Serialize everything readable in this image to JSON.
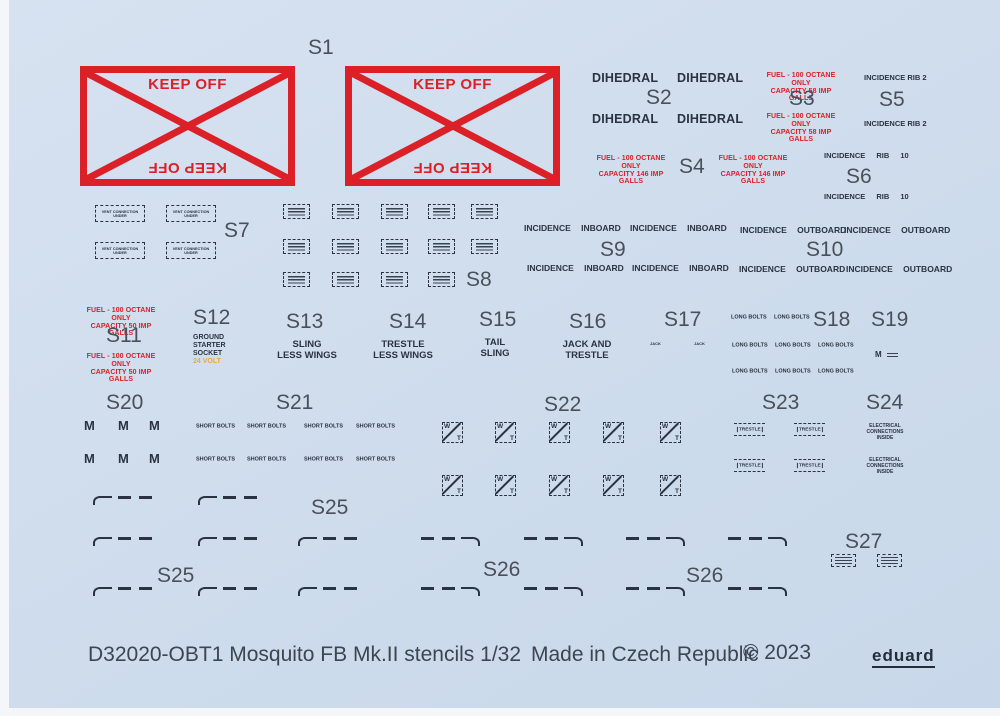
{
  "colors": {
    "background": "#cfdded",
    "red": "#dc2027",
    "dark": "#2b3340",
    "orange": "#e9a93c"
  },
  "s1": {
    "label": "S1",
    "text": "KEEP OFF"
  },
  "s2": {
    "label": "S2",
    "text": "DIHEDRAL"
  },
  "s3": {
    "label": "S3",
    "line1": "FUEL - 100 OCTANE ONLY",
    "line2": "CAPACITY 58 IMP GALLS"
  },
  "s4": {
    "label": "S4",
    "line1": "FUEL - 100 OCTANE ONLY",
    "line2": "CAPACITY 146 IMP GALLS"
  },
  "s5": {
    "label": "S5",
    "text": "INCIDENCE RIB 2"
  },
  "s6": {
    "label": "S6",
    "text": "INCIDENCE RIB 10"
  },
  "s7": {
    "label": "S7",
    "box_text": "VENT CONNECTION UNDER"
  },
  "s8": {
    "label": "S8"
  },
  "s9": {
    "label": "S9",
    "text": "INCIDENCE INBOARD"
  },
  "s10": {
    "label": "S10",
    "text": "INCIDENCE OUTBOARD"
  },
  "s11": {
    "label": "S11",
    "line1": "FUEL - 100 OCTANE ONLY",
    "line2": "CAPACITY 50 IMP GALLS"
  },
  "s12": {
    "label": "S12",
    "line1": "GROUND",
    "line2": "STARTER",
    "line3": "SOCKET",
    "line4": "24 VOLT"
  },
  "s13": {
    "label": "S13",
    "line1": "SLING",
    "line2": "LESS WINGS"
  },
  "s14": {
    "label": "S14",
    "line1": "TRESTLE",
    "line2": "LESS WINGS"
  },
  "s15": {
    "label": "S15",
    "line1": "TAIL",
    "line2": "SLING"
  },
  "s16": {
    "label": "S16",
    "line1": "JACK AND",
    "line2": "TRESTLE"
  },
  "s17": {
    "label": "S17",
    "text": "JACK"
  },
  "s18": {
    "label": "S18",
    "text": "LONG BOLTS"
  },
  "s19": {
    "label": "S19",
    "text": "M"
  },
  "s20": {
    "label": "S20",
    "text": "M"
  },
  "s21": {
    "label": "S21",
    "text": "SHORT BOLTS"
  },
  "s22": {
    "label": "S22",
    "w": "W",
    "t": "T"
  },
  "s23": {
    "label": "S23",
    "text": "TRESTLE"
  },
  "s24": {
    "label": "S24",
    "line1": "ELECTRICAL",
    "line2": "CONNECTIONS",
    "line3": "INSIDE"
  },
  "s25": {
    "label": "S25"
  },
  "s26": {
    "label": "S26"
  },
  "s27": {
    "label": "S27"
  },
  "footer": {
    "product": "D32020-OBT1 Mosquito FB Mk.II stencils 1/32",
    "made_in": "Made in Czech Republic",
    "copyright": "© 2023",
    "brand": "eduard"
  }
}
